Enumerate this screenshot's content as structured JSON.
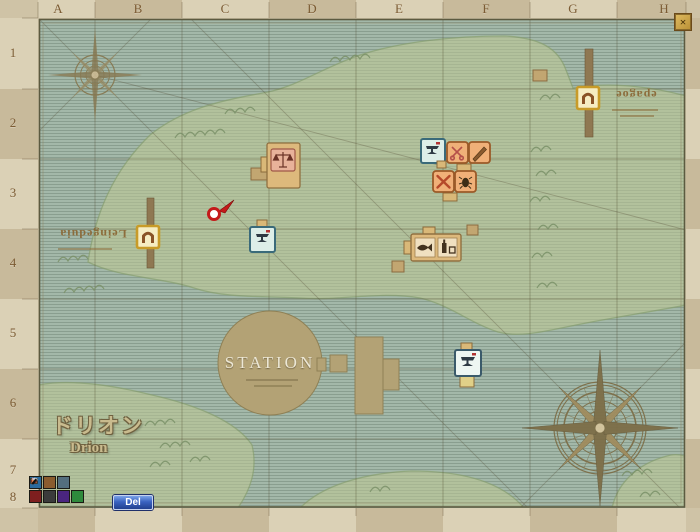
{
  "window": {
    "close_glyph": "×"
  },
  "grid": {
    "columns": [
      "A",
      "B",
      "C",
      "D",
      "E",
      "F",
      "G",
      "H"
    ],
    "rows": [
      "1",
      "2",
      "3",
      "4",
      "5",
      "6",
      "7",
      "8"
    ]
  },
  "map": {
    "station_label": "STATION",
    "region_title_jp": "ドリオン",
    "region_title_en": "Drion",
    "west_gate_label": "Leingeduia",
    "north_gate_label": "epagoe",
    "markers": [
      "player-position-flag",
      "market-building",
      "blacksmith-west",
      "blacksmith-north",
      "tool-shop-scissors-sword",
      "workshop-x-bug",
      "tavern-building",
      "blacksmith-south",
      "west-gate",
      "north-gate",
      "station-circle",
      "cross-building",
      "pier-west",
      "pier-north"
    ]
  },
  "toolbar": {
    "delete_label": "Del"
  },
  "legend_icons": [
    "fish-marker",
    "chest-marker",
    "flag-marker",
    "meat-marker",
    "axe-marker",
    "pickaxe-marker",
    "herb-marker"
  ],
  "colors": {
    "sea": "#a3b8a9",
    "land": "#b2c19c",
    "parchment": "#cfc3a6",
    "grid_line": "#56503a",
    "marker_red": "#c41a1a",
    "button_blue": "#3a62c0",
    "gate_gold": "#d9b832",
    "station_tan": "#b3a275"
  }
}
